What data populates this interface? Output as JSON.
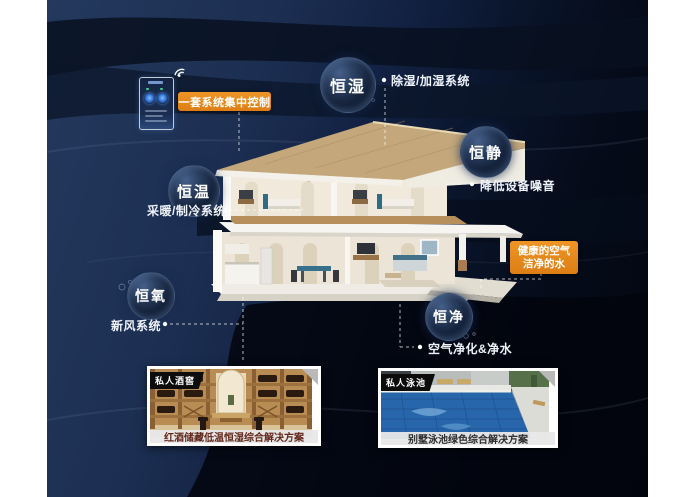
{
  "control": {
    "label": "一套系统集中控制",
    "device": "smartphone-home-controller"
  },
  "features": [
    {
      "id": "heng-shi",
      "label": "恒湿",
      "note": "除湿/加湿系统"
    },
    {
      "id": "heng-jing",
      "label": "恒静",
      "note": "降低设备噪音"
    },
    {
      "id": "heng-wen",
      "label": "恒温",
      "note": "采暖/制冷系统"
    },
    {
      "id": "heng-yang",
      "label": "恒氧",
      "note": "新风系统"
    },
    {
      "id": "heng-jing2",
      "label": "恒净",
      "note": "空气净化&净水"
    }
  ],
  "callout": {
    "line1": "健康的空气",
    "line2": "洁净的水"
  },
  "cards": [
    {
      "tag": "私人酒窖",
      "caption": "红酒储藏低温恒湿综合解决方案"
    },
    {
      "tag": "私人泳池",
      "caption": "别墅泳池绿色综合解决方案"
    }
  ],
  "colors": {
    "accent_orange": "#e5861d",
    "background_navy": "#1d3358",
    "background_dark": "#05080f",
    "bubble_rim": "#46608a",
    "connector": "#ffffff"
  },
  "icons": [
    "wifi-icon"
  ]
}
